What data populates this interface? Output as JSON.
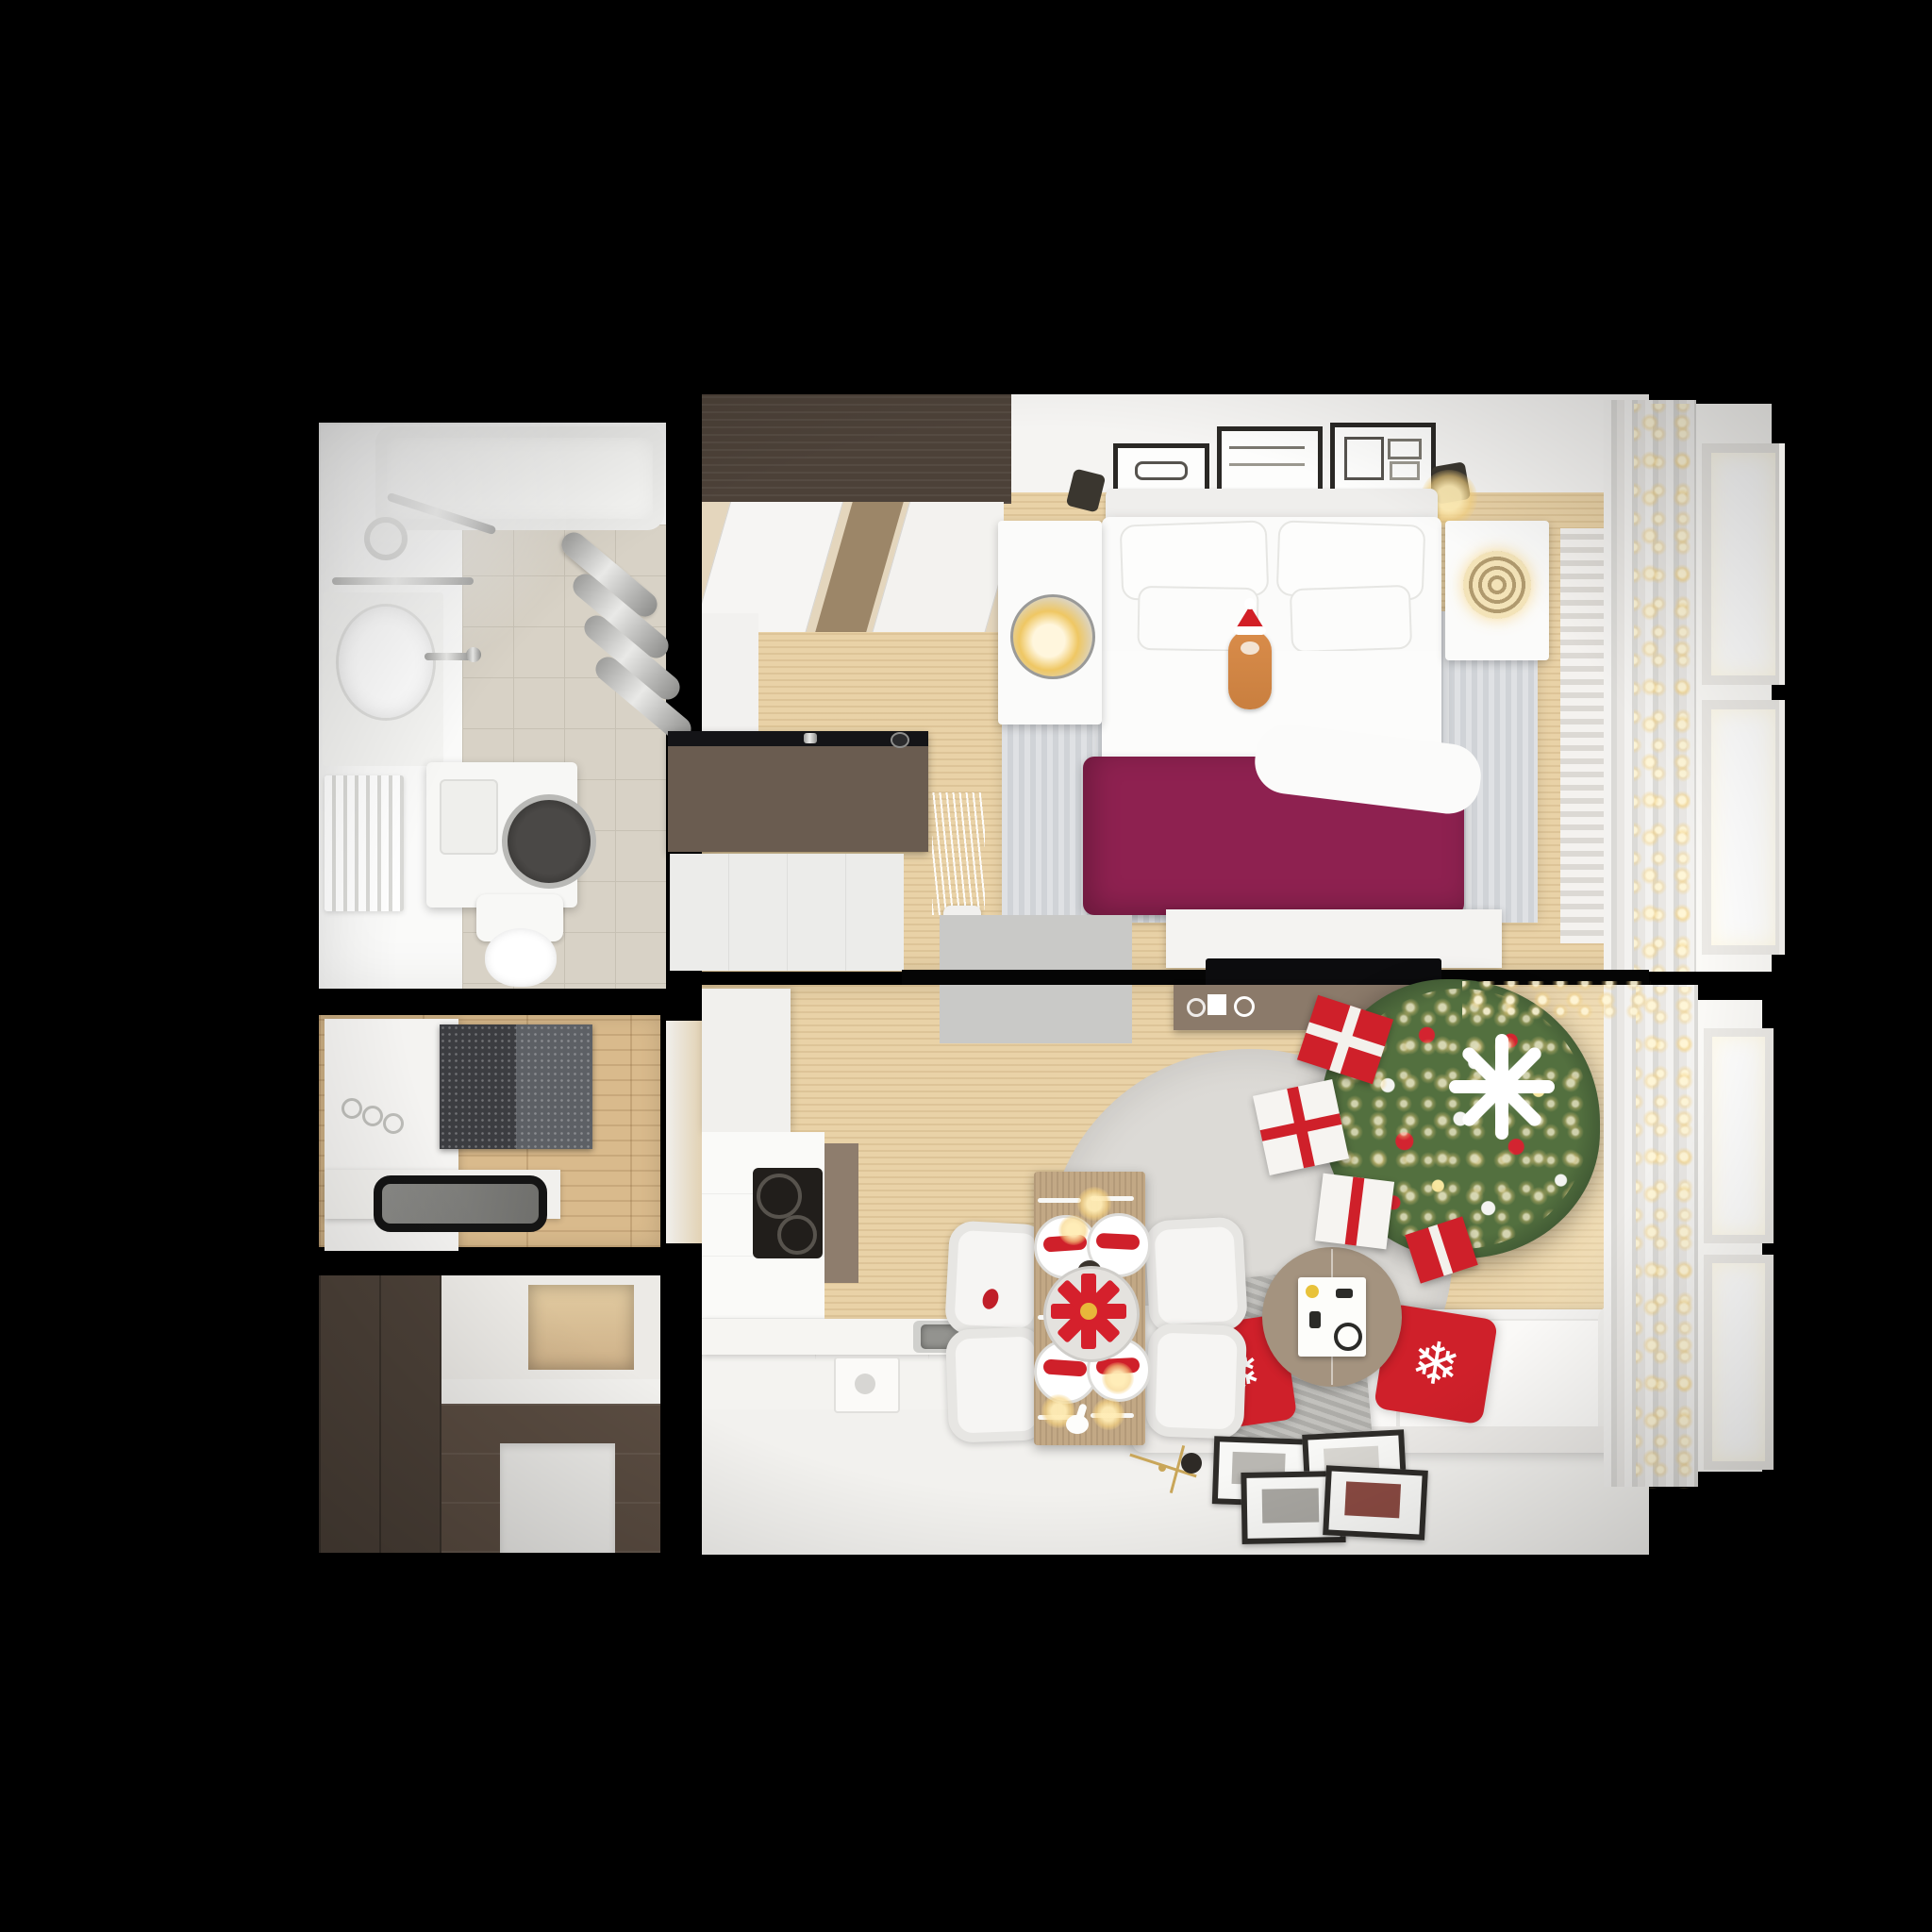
{
  "scene": {
    "type": "3d-top-view-floor-plan",
    "setting": "one-bedroom apartment with christmas decorations, rendered from above on black background",
    "background": "#000000",
    "palette": {
      "wood": "#e9d2a7",
      "hall_wood": "#d9ba8c",
      "white_floor": "#f2f1ee",
      "tile": "#d8d2c6",
      "wall_white": "#f5f4f2",
      "wenge": "#4c4138",
      "entry_brown": "#5a4c41",
      "desk_brown": "#6a5c50",
      "console_taupe": "#8b7a6a",
      "duvet": "#8e2150",
      "red": "#cf202a",
      "tree_green": "#53703f",
      "gold": "#e9c887",
      "mat": "#c9c9c7",
      "rug": "#d9d7d3",
      "bed_rug": "#d7d9dc",
      "sofa": "#f3f2f0",
      "throw": "#b5b4b0",
      "chrome": "#c9c9c6",
      "black_fixture": "#17171a"
    },
    "icons": {
      "snowflake": "❄"
    },
    "rooms": [
      {
        "name": "bathroom",
        "furniture": [
          "bathtub",
          "shower-mixer",
          "towel-radiator",
          "vanity-sink",
          "heated-towel-rail",
          "washing-machine",
          "toilet"
        ]
      },
      {
        "name": "bedroom",
        "furniture": [
          "wardrobe",
          "wall-picture-frames",
          "wall-sconces",
          "nightstands",
          "globe-lamp",
          "rattan-lamp",
          "double-bed",
          "white-pillows",
          "magenta-duvet",
          "cat-with-santa-hat",
          "striped-rug",
          "desk",
          "dresser",
          "pampas-vase",
          "tv-bench",
          "tv",
          "door-mat",
          "curtains",
          "windows",
          "fairy-lights"
        ]
      },
      {
        "name": "living-room",
        "furniture": [
          "kitchen-cabinets",
          "cooktop",
          "kitchen-sink",
          "media-console",
          "wall-tv",
          "christmas-tree",
          "gift-boxes",
          "round-rug",
          "side-table",
          "sofa",
          "snowflake-pillows",
          "knit-throw",
          "dining-table",
          "dining-chairs",
          "place-settings",
          "poinsettia-centerpiece",
          "candles",
          "floor-picture-frames",
          "wall-clock",
          "curtains",
          "windows",
          "fairy-lights"
        ]
      },
      {
        "name": "hallway",
        "furniture": [
          "console-bench",
          "mirror-tray",
          "glitter-doormat",
          "light-switches"
        ]
      },
      {
        "name": "entry-closet",
        "furniture": [
          "wenge-wardrobe",
          "upper-cabinet",
          "wood-niche",
          "lower-cabinet",
          "appliance"
        ]
      }
    ],
    "counts": {
      "bed_pillows": 4,
      "wall_frames": 3,
      "dining_plates": 4,
      "dining_chairs": 4,
      "gift_boxes": 4,
      "snowflake_pillows": 2,
      "floor_frames": 4,
      "window_bays": 2
    }
  }
}
